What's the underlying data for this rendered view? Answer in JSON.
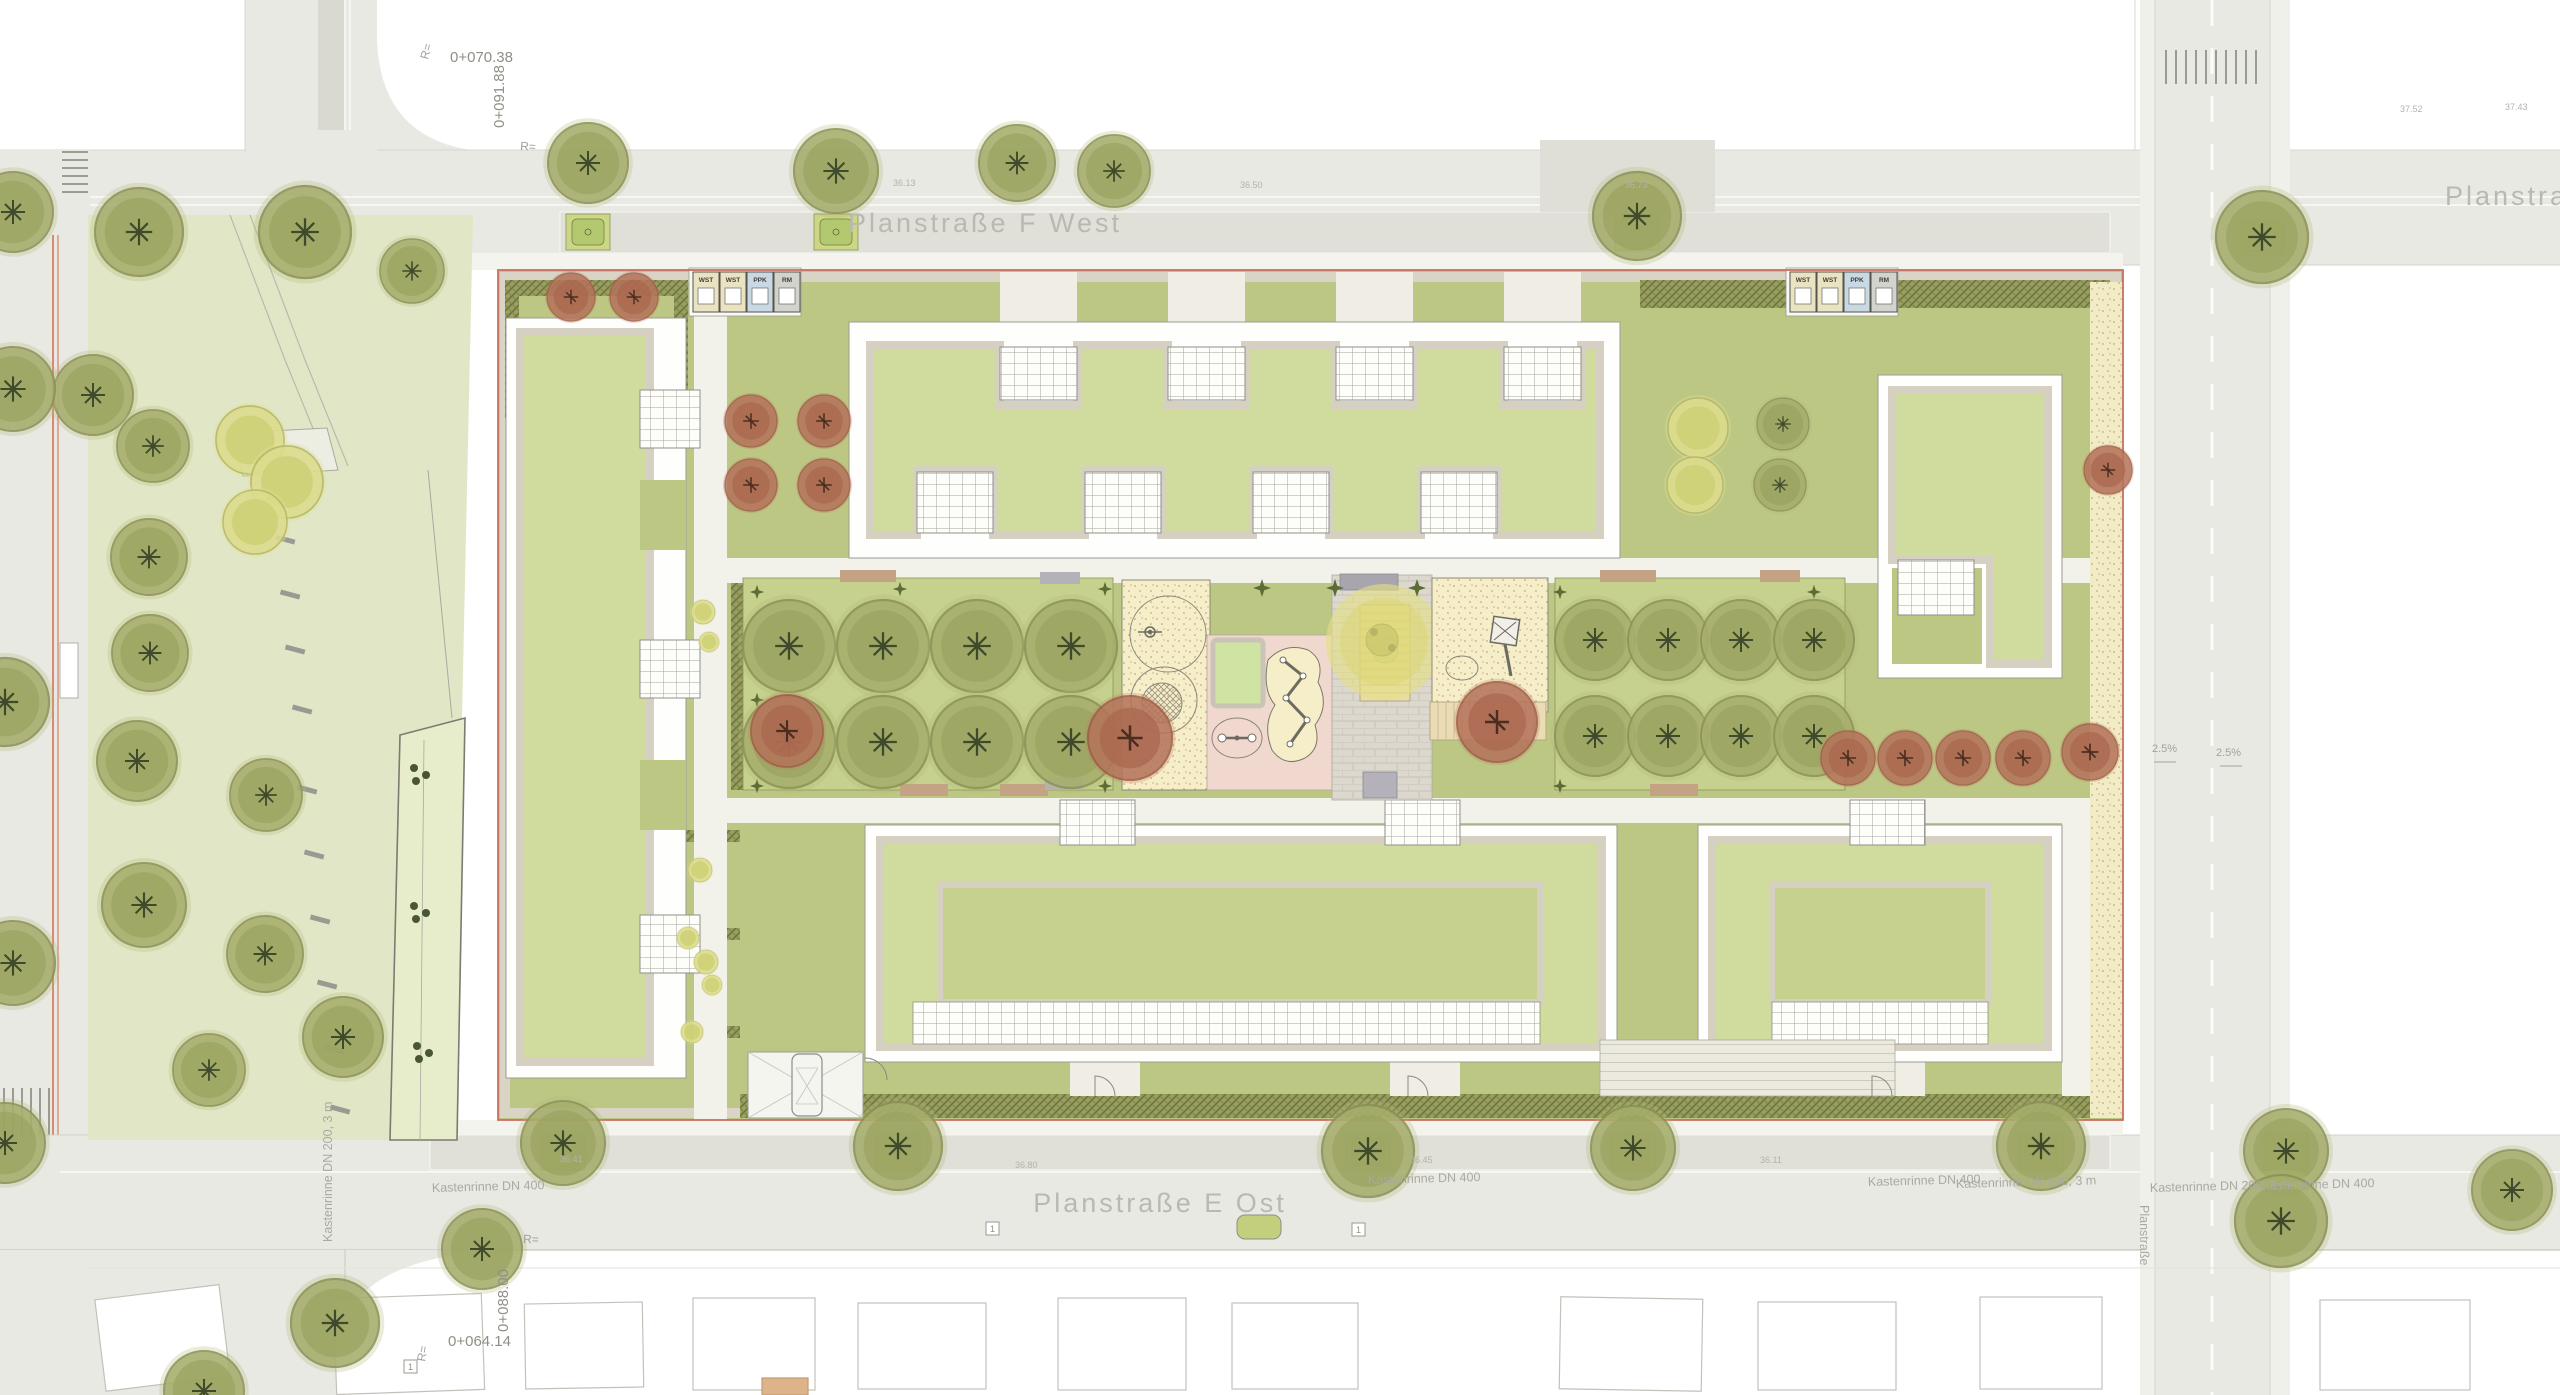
{
  "plan": {
    "type": "site-plan",
    "streets": {
      "north_label": "Planstraße F West",
      "south_label": "Planstraße E Ost",
      "east_label": "Planstraße",
      "east_vertical_label": "Planstraße"
    },
    "chainage": {
      "top": "0+070.38",
      "top_vertical": "0+091.88",
      "bottom_vertical": "0+088.00",
      "bottom": "0+064.14"
    },
    "radius_labels": [
      "R=",
      "R=",
      "R=",
      "R="
    ],
    "drains": [
      "Kastenrinne DN 400",
      "Kastenrinne DN 400",
      "Kastenrinne DN 400",
      "Kastenrinne DN 200, 3 m",
      "Kastenrinne DN 200, 3 m",
      "Kastenrinne DN 400",
      "Kastenrinne DN 200, 3 m"
    ],
    "slopes": [
      "2.5%",
      "2.5%"
    ],
    "elevations": [
      "36.13",
      "36.50",
      "36.73",
      "37.52",
      "37.43",
      "36.41",
      "36.80",
      "36.45",
      "36.11"
    ],
    "ref_markers": [
      "1",
      "1",
      "1"
    ],
    "waste_bins": [
      "WST",
      "WST",
      "PPK",
      "RM"
    ],
    "colors": {
      "boundary_red": "#c96f5f",
      "street_gray": "#e9e9e3",
      "parking_gray": "#e0e0d8",
      "park_green": "#e1e7c6",
      "garden_green": "#bcc784",
      "lawn_green": "#c5d18d",
      "roof_green": "#cfdc9e",
      "hedge_olive": "#99a05e",
      "tree_olive": "#a7ae6c",
      "tree_red": "#b4725a",
      "tree_yellow": "#dcdc8c",
      "sand": "#f2ecc6",
      "play_sand": "#f6eec9",
      "play_pink": "#f0d8cf",
      "bin_cream": "#eae3c2",
      "bin_blue": "#c8d8e4",
      "bin_gray": "#d3d3cd",
      "label_gray": "#b9b9b1"
    }
  }
}
